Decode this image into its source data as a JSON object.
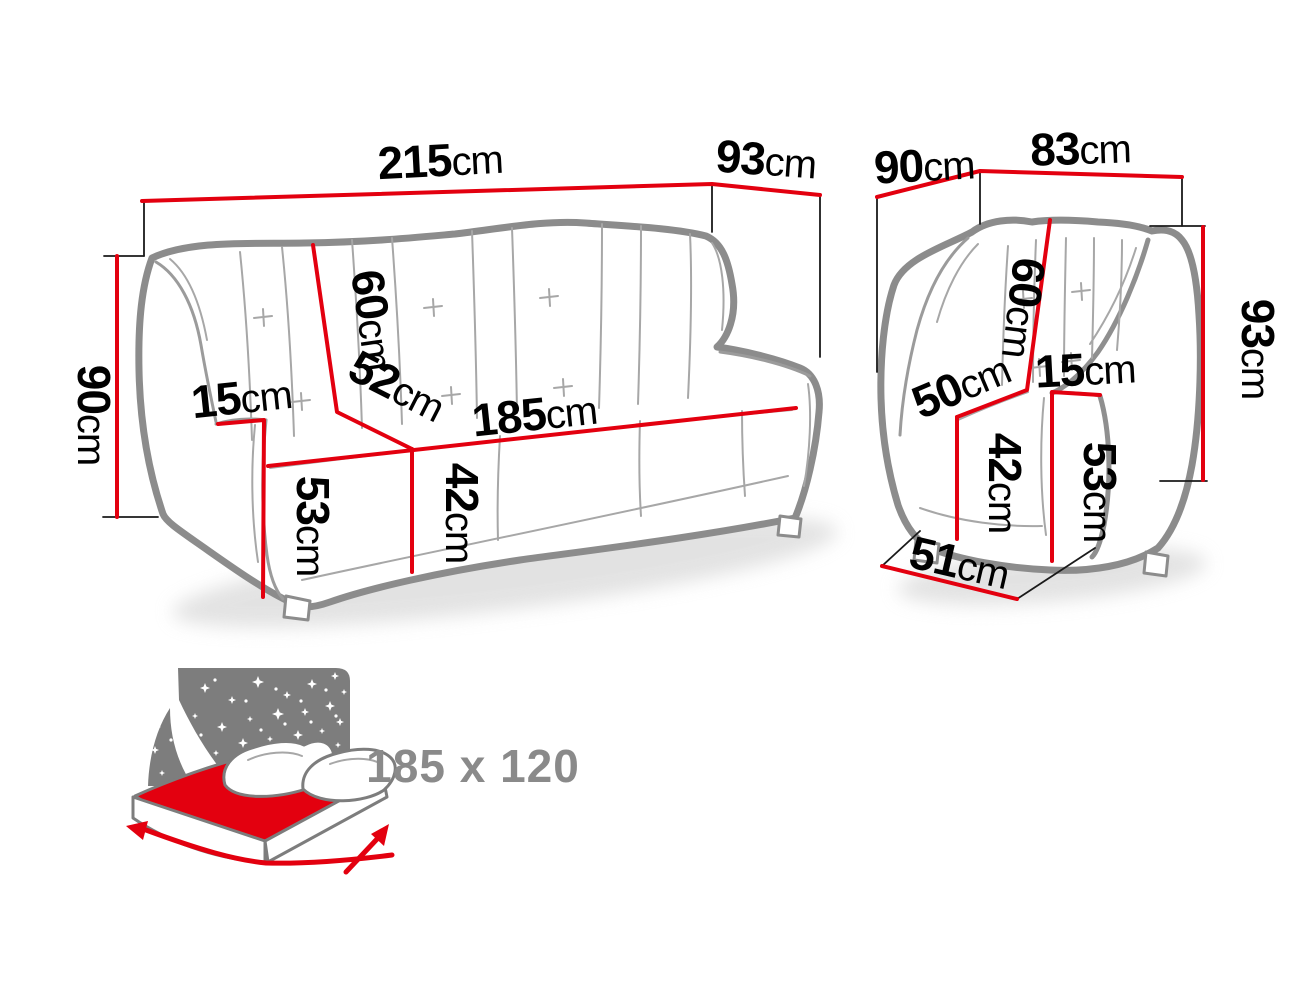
{
  "colors": {
    "dimension_line": "#e3000f",
    "outline_gray": "#8c8c8c",
    "label_black": "#000000",
    "bed_gray": "#7d7d7d",
    "bed_text_gray": "#8a8a8a"
  },
  "sofa": {
    "labels": {
      "width": {
        "value": "215",
        "unit": "cm"
      },
      "depth": {
        "value": "93",
        "unit": "cm"
      },
      "height": {
        "value": "90",
        "unit": "cm"
      },
      "back_height": {
        "value": "60",
        "unit": "cm"
      },
      "armrest_width": {
        "value": "15",
        "unit": "cm"
      },
      "seat_depth": {
        "value": "52",
        "unit": "cm"
      },
      "seat_width": {
        "value": "185",
        "unit": "cm"
      },
      "seat_height": {
        "value": "42",
        "unit": "cm"
      },
      "armrest_height": {
        "value": "53",
        "unit": "cm"
      }
    }
  },
  "armchair": {
    "labels": {
      "depth": {
        "value": "90",
        "unit": "cm"
      },
      "width": {
        "value": "83",
        "unit": "cm"
      },
      "height": {
        "value": "93",
        "unit": "cm"
      },
      "back_height": {
        "value": "60",
        "unit": "cm"
      },
      "seat_depth": {
        "value": "50",
        "unit": "cm"
      },
      "armrest_width": {
        "value": "15",
        "unit": "cm"
      },
      "seat_height": {
        "value": "42",
        "unit": "cm"
      },
      "armrest_height": {
        "value": "53",
        "unit": "cm"
      },
      "base_depth": {
        "value": "51",
        "unit": "cm"
      }
    }
  },
  "bed": {
    "sleeping_area": "185 x 120"
  }
}
